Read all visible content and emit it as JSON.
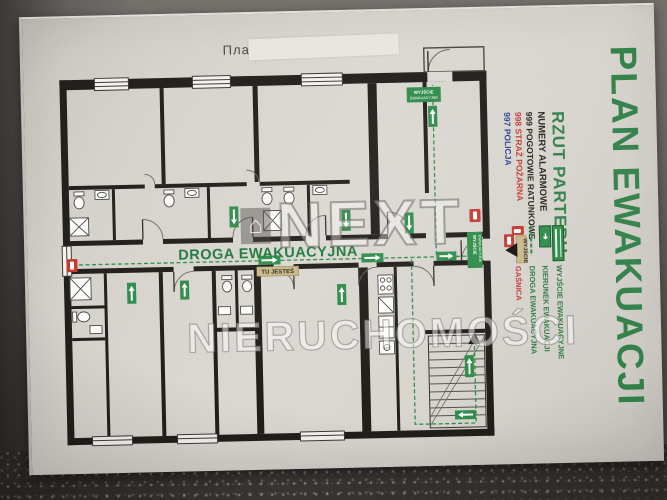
{
  "photo": {
    "wall_note": "Пла",
    "watermark": {
      "brand": "NEXT",
      "subtitle": "NIERUCHOMOŚCI"
    }
  },
  "poster": {
    "title": "PLAN EWAKUACJI",
    "subtitle": "RZUT PARTERU",
    "alarm_numbers": {
      "heading": "NUMERY ALARMOWE",
      "items": [
        {
          "number": "999",
          "label": "POGOTOWIE RATUNKOWE"
        },
        {
          "number": "998",
          "label": "STRAŻ POŻARNA"
        },
        {
          "number": "997",
          "label": "POLICJA"
        }
      ]
    },
    "legend": {
      "items": [
        {
          "label": "WYJŚCIE EWAKUACYJNE",
          "icon": "exit-sign-icon"
        },
        {
          "label": "KIERUNEK EWAKUACJI",
          "icon": "direction-arrow-icon"
        },
        {
          "label": "DROGA EWAKUACYJNA",
          "icon": "route-line-icon"
        },
        {
          "label": "GAŚNICA",
          "icon": "extinguisher-icon"
        }
      ]
    },
    "plan": {
      "corridor_label": "DROGA EWAKUACYJNA",
      "you_are_here_label": "TU JESTEŚ",
      "exit_marker_label": "WYJŚCIE",
      "exit_sign_line1": "WYJŚCIE",
      "exit_sign_line2": "EWAKUACYJNE"
    },
    "colors": {
      "evacuation_green": "#2F8D4A",
      "title_green": "#33814A",
      "alarm_red": "#C43A31",
      "police_blue": "#27418F",
      "marker_tan": "#C9B98B",
      "wall_black": "#211E1B"
    }
  }
}
